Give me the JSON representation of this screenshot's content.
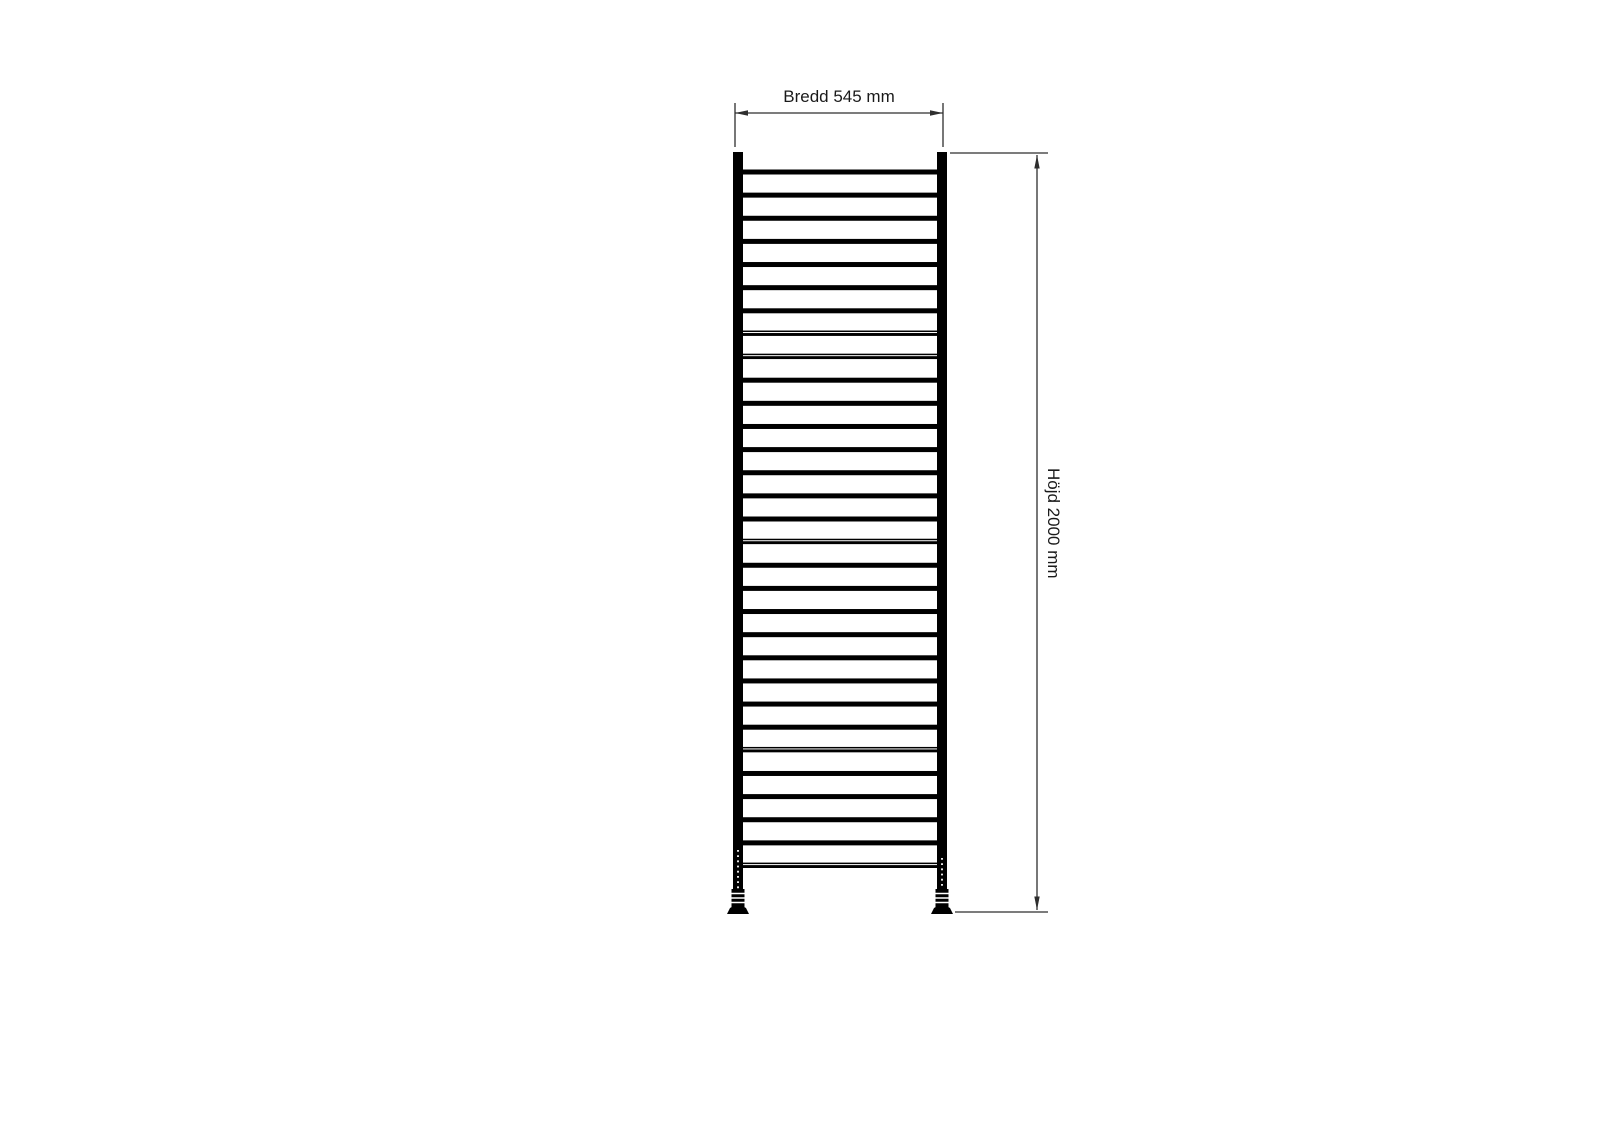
{
  "page": {
    "background": "#ffffff"
  },
  "drawing": {
    "description": "Front elevation technical drawing of a tall ladder-style shelving side frame with two vertical posts, horizontal rungs and adjustable feet",
    "labels": {
      "width": "Bredd 545 mm",
      "height": "Höjd 2000 mm"
    },
    "values": {
      "width_mm": 545,
      "height_mm": 2000
    },
    "frame": {
      "post_count": 2,
      "rung_count": 31,
      "thin_double_rung_indices": [
        7,
        8,
        16,
        25,
        30
      ],
      "feet_count": 2
    },
    "colors": {
      "frame": "#000000",
      "dimension_lines": "#2e2e2e",
      "text": "#1a1a1a"
    }
  }
}
